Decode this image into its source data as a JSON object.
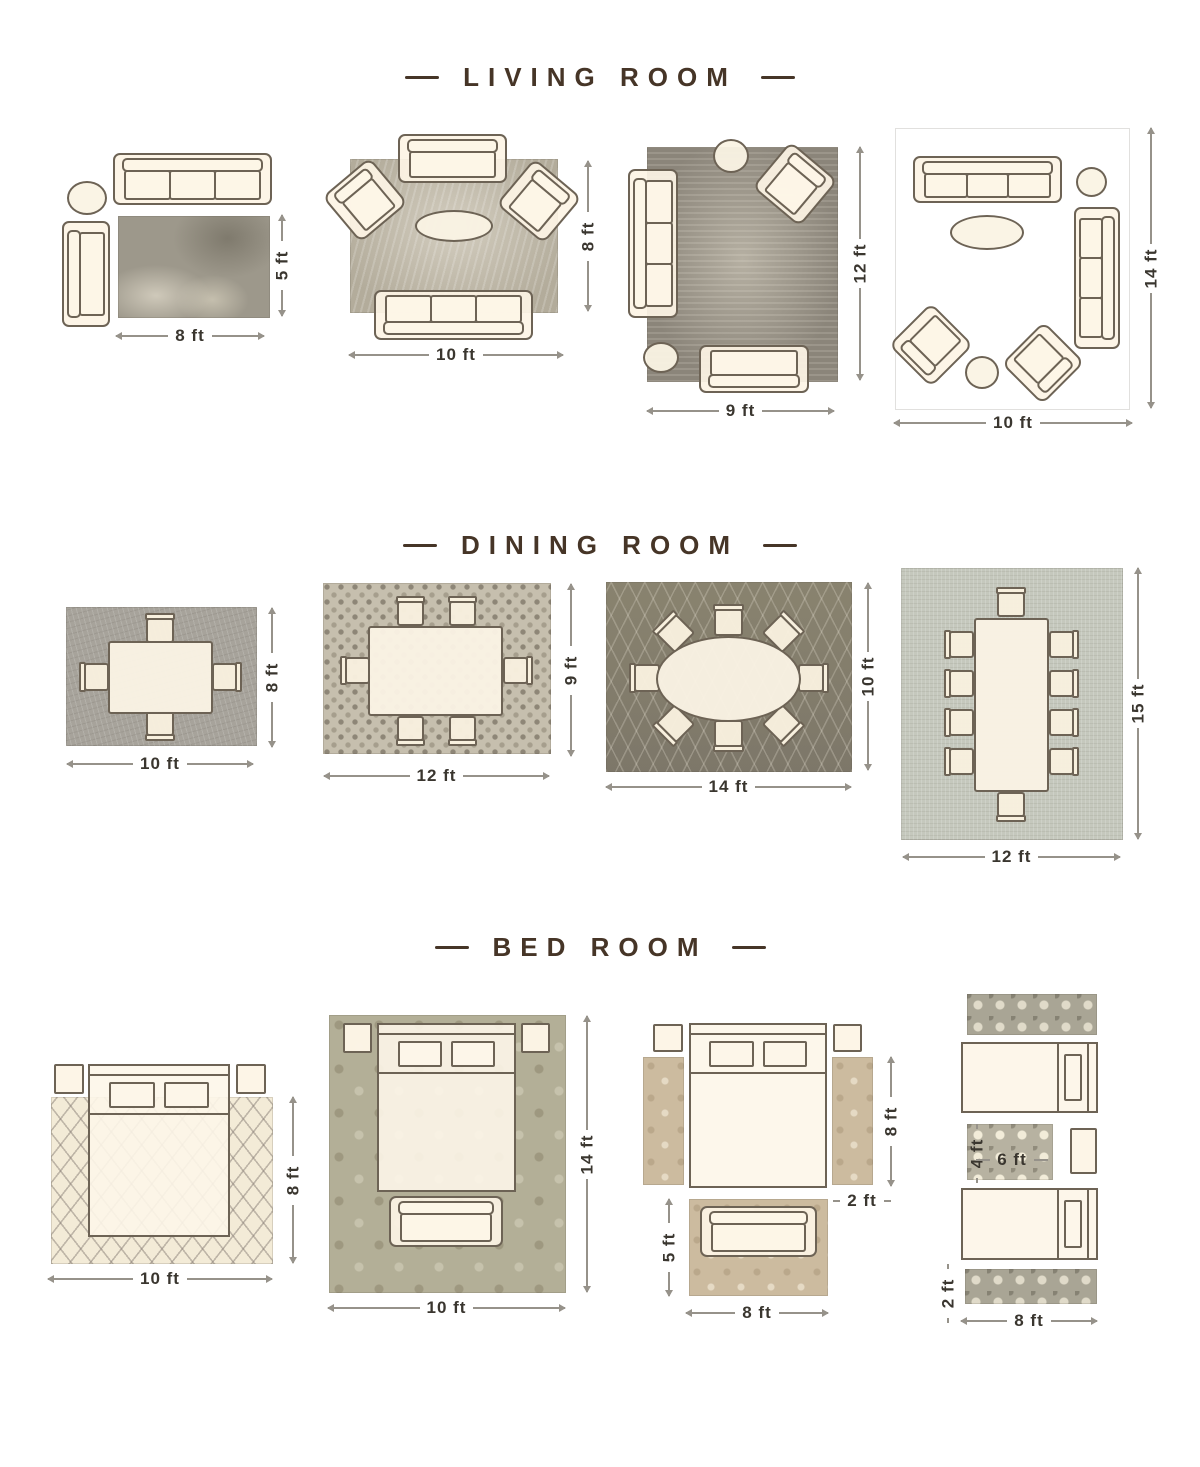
{
  "colors": {
    "accent_brown": "#463527",
    "furniture_fill": "#fdf4e6",
    "furniture_outline": "#6d6355",
    "dimension_text": "#3a362f"
  },
  "sections": [
    {
      "id": "living-room",
      "title": "LIVING ROOM",
      "layouts": [
        {
          "width": "8 ft",
          "height": "5 ft",
          "furniture": [
            "three-seat-sofa",
            "chaise",
            "round-side-table",
            "area-rug"
          ]
        },
        {
          "width": "10 ft",
          "height": "8 ft",
          "furniture": [
            "loveseat",
            "armchair",
            "armchair",
            "oval-coffee-table",
            "three-seat-sofa",
            "area-rug"
          ]
        },
        {
          "width": "9 ft",
          "height": "12 ft",
          "furniture": [
            "three-seat-sofa",
            "armchair",
            "round-side-table",
            "round-side-table",
            "loveseat",
            "area-rug"
          ]
        },
        {
          "width": "10 ft",
          "height": "14 ft",
          "furniture": [
            "three-seat-sofa",
            "three-seat-sofa",
            "armchair",
            "armchair",
            "oval-coffee-table",
            "round-side-table",
            "round-side-table",
            "area-rug"
          ]
        }
      ]
    },
    {
      "id": "dining-room",
      "title": "DINING ROOM",
      "layouts": [
        {
          "width": "10 ft",
          "height": "8 ft",
          "table": "rectangular",
          "chairs": 4
        },
        {
          "width": "12 ft",
          "height": "9 ft",
          "table": "rectangular",
          "chairs": 6
        },
        {
          "width": "14 ft",
          "height": "10 ft",
          "table": "oval",
          "chairs": 8
        },
        {
          "width": "12 ft",
          "height": "15 ft",
          "table": "rectangular",
          "chairs": 10
        }
      ]
    },
    {
      "id": "bed-room",
      "title": "BED ROOM",
      "layouts": [
        {
          "width": "10 ft",
          "height": "8 ft",
          "furniture": [
            "queen-bed",
            "nightstand",
            "nightstand",
            "area-rug"
          ]
        },
        {
          "width": "10 ft",
          "height": "14 ft",
          "furniture": [
            "queen-bed",
            "nightstand",
            "nightstand",
            "bench",
            "area-rug"
          ]
        },
        {
          "width": "8 ft",
          "height": "8 ft",
          "runner_width": "2 ft",
          "foot_rug_height": "5 ft",
          "furniture": [
            "queen-bed",
            "nightstand",
            "nightstand",
            "runner-rug",
            "runner-rug",
            "bench",
            "accent-rug"
          ]
        },
        {
          "width": "8 ft",
          "runner_height": "2 ft",
          "center_rug_height": "4 ft",
          "center_rug_width": "6 ft",
          "furniture": [
            "twin-bed",
            "twin-bed",
            "nightstand",
            "runner-rug",
            "runner-rug",
            "accent-rug"
          ]
        }
      ]
    }
  ]
}
